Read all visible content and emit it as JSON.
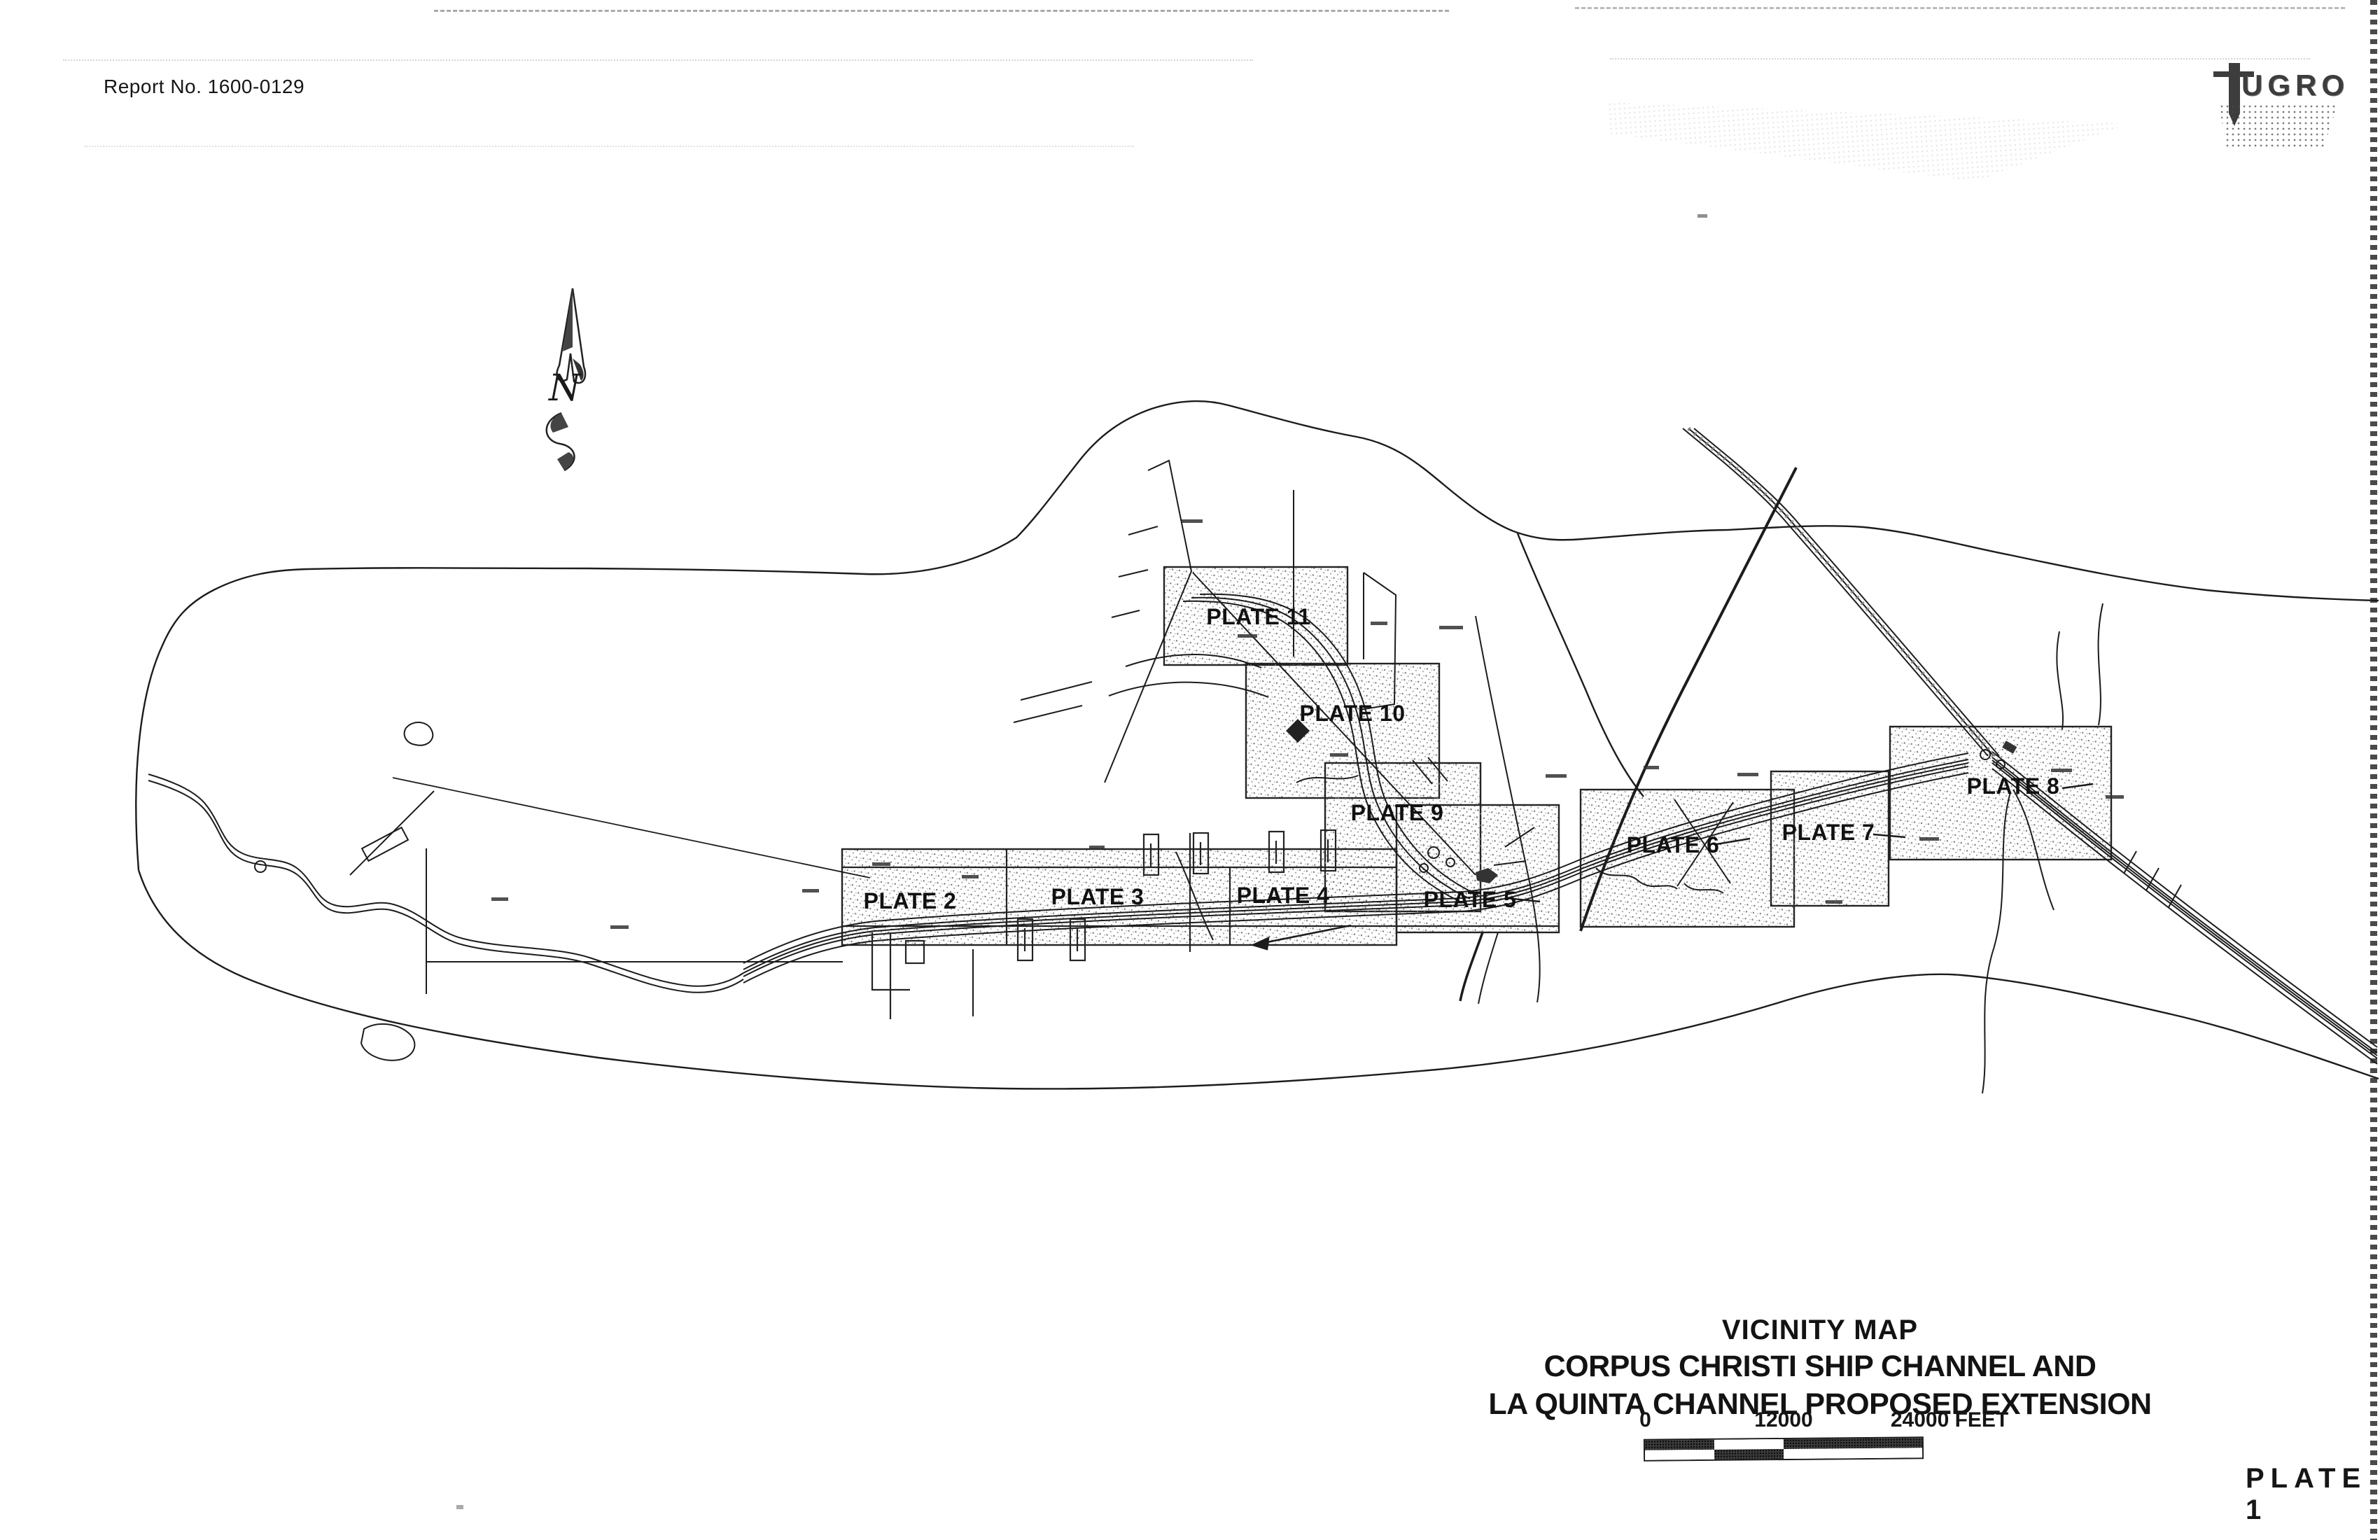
{
  "page": {
    "report_no": "Report No. 1600-0129",
    "plate_no": "PLATE 1",
    "paper_color": "#ffffff",
    "ink_color": "#1c1c1c",
    "stipple_color": "#8a8a8a"
  },
  "logo": {
    "brand": "fugro",
    "letters": "UGRO"
  },
  "north_arrow": {
    "label": "N"
  },
  "map": {
    "plates": [
      {
        "label": "PLATE 2"
      },
      {
        "label": "PLATE 3"
      },
      {
        "label": "PLATE 4"
      },
      {
        "label": "PLATE 5"
      },
      {
        "label": "PLATE 6"
      },
      {
        "label": "PLATE 7"
      },
      {
        "label": "PLATE 8"
      },
      {
        "label": "PLATE 9"
      },
      {
        "label": "PLATE 10"
      },
      {
        "label": "PLATE 11"
      }
    ]
  },
  "title_block": {
    "title": "VICINITY MAP",
    "subtitle_line1": "CORPUS CHRISTI SHIP CHANNEL AND",
    "subtitle_line2": "LA QUINTA CHANNEL PROPOSED EXTENSION"
  },
  "scale_bar": {
    "tick_start": "0",
    "tick_mid": "12000",
    "tick_end": "24000 FEET"
  }
}
